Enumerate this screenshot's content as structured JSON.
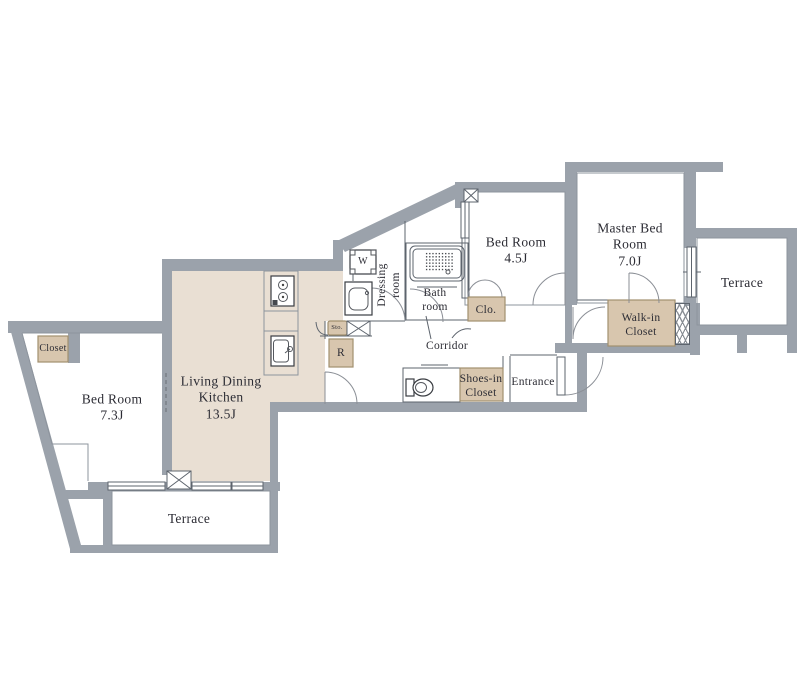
{
  "colors": {
    "wall": "#9ba2ab",
    "line": "#5d646d",
    "thin_line": "#8d949d",
    "room_fill": "#e9dfd3",
    "closet_fill": "#d8c6ae",
    "closet_border": "#a2906f",
    "ink": "#2c2c34"
  },
  "rooms": {
    "ldk": {
      "line1": "Living Dining",
      "line2": "Kitchen",
      "size": "13.5J"
    },
    "bedroom1": {
      "line1": "Bed Room",
      "size": "7.3J"
    },
    "bedroom2": {
      "line1": "Bed Room",
      "size": "4.5J"
    },
    "master": {
      "line1": "Master Bed",
      "line2": "Room",
      "size": "7.0J"
    },
    "terrace_bottom": {
      "label": "Terrace"
    },
    "terrace_right": {
      "label": "Terrace"
    },
    "closet": {
      "label": "Closet"
    },
    "walkin": {
      "line1": "Walk-in",
      "line2": "Closet"
    },
    "shoes": {
      "line1": "Shoes-in",
      "line2": "Closet"
    },
    "clo": {
      "label": "Clo."
    },
    "bath": {
      "line1": "Bath",
      "line2": "room"
    },
    "dressing": {
      "line1": "Dressing",
      "line2": "room"
    },
    "corridor": {
      "label": "Corridor"
    },
    "entrance": {
      "label": "Entrance"
    }
  },
  "fixtures": {
    "washer": "W",
    "refrigerator": "R",
    "storage": "Sto."
  }
}
